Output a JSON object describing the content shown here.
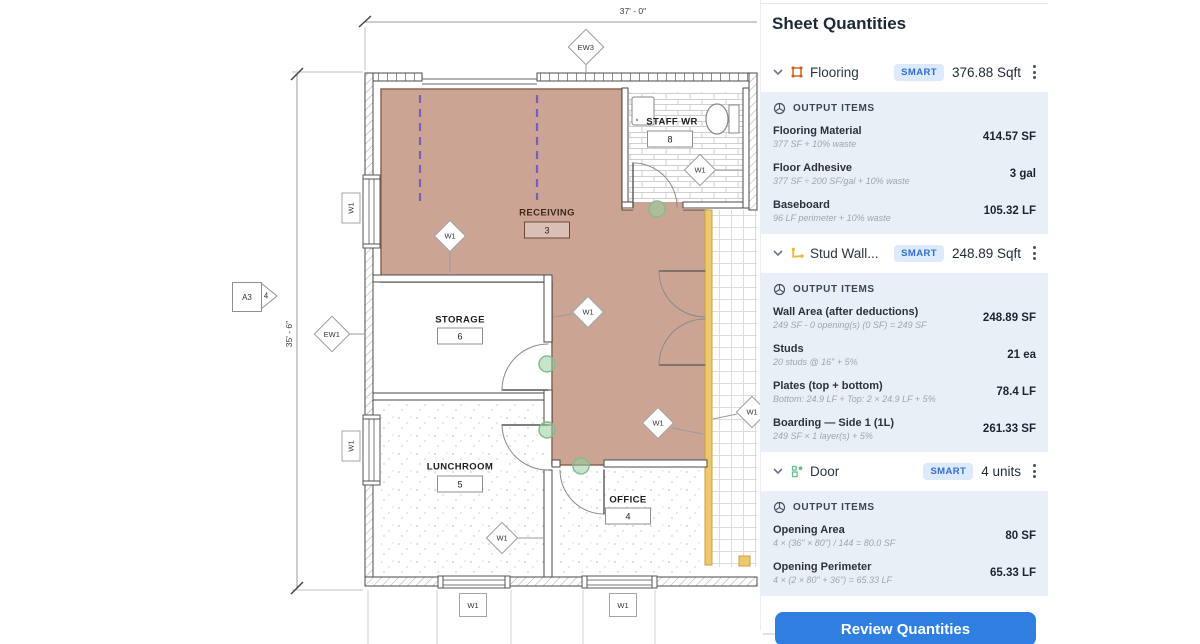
{
  "plan": {
    "dimensions": {
      "top": "37' - 0\"",
      "left": "35' - 6\""
    },
    "section_marker": {
      "sheet": "A3",
      "detail": "4"
    },
    "wall_tags": {
      "ew3": "EW3",
      "ew1": "EW1",
      "w1": "W1"
    },
    "rooms": [
      {
        "name": "RECEIVING",
        "number": "3"
      },
      {
        "name": "STAFF WR",
        "number": "8"
      },
      {
        "name": "STORAGE",
        "number": "6"
      },
      {
        "name": "LUNCHROOM",
        "number": "5"
      },
      {
        "name": "OFFICE",
        "number": "4"
      }
    ],
    "colors": {
      "flooring_highlight": "#cba494",
      "wall_highlight_yellow": "#eec86e",
      "vertex_marker_green": "#8cc89a",
      "overhead_dashed_purple": "#7a5fb5"
    }
  },
  "panel": {
    "title": "Sheet Quantities",
    "output_items_label": "OUTPUT ITEMS",
    "review_button": "Review Quantities",
    "icons": {
      "flooring": "area-takeoff-icon",
      "stud_wall": "linear-takeoff-icon",
      "door": "count-takeoff-icon",
      "output_items": "cube-icon",
      "section_expand": "chevron-down-icon",
      "section_menu": "kebab-menu-icon"
    },
    "colors": {
      "accent_blue": "#2e7fe0",
      "badge_bg": "#dde9fc",
      "badge_text": "#2e6fd6",
      "output_block_bg": "#e9eff7",
      "flooring_icon": "#d9703c",
      "stud_icon": "#e8b93c",
      "door_icon": "#6abf8a"
    },
    "sections": [
      {
        "name": "Flooring",
        "badge": "SMART",
        "quantity": "376.88 Sqft",
        "items": [
          {
            "title": "Flooring Material",
            "formula": "377 SF + 10% waste",
            "value": "414.57 SF"
          },
          {
            "title": "Floor Adhesive",
            "formula": "377 SF ÷ 200 SF/gal + 10% waste",
            "value": "3 gal"
          },
          {
            "title": "Baseboard",
            "formula": "96 LF perimeter + 10% waste",
            "value": "105.32 LF"
          }
        ]
      },
      {
        "name": "Stud Wall...",
        "badge": "SMART",
        "quantity": "248.89 Sqft",
        "items": [
          {
            "title": "Wall Area (after deductions)",
            "formula": "249 SF - 0 opening(s) (0 SF) = 249 SF",
            "value": "248.89 SF"
          },
          {
            "title": "Studs",
            "formula": "20 studs @ 16\" + 5%",
            "value": "21 ea"
          },
          {
            "title": "Plates (top + bottom)",
            "formula": "Bottom: 24.9 LF + Top: 2 × 24.9 LF + 5%",
            "value": "78.4 LF"
          },
          {
            "title": "Boarding — Side 1 (1L)",
            "formula": "249 SF × 1 layer(s) + 5%",
            "value": "261.33 SF"
          }
        ]
      },
      {
        "name": "Door",
        "badge": "SMART",
        "quantity": "4 units",
        "items": [
          {
            "title": "Opening Area",
            "formula": "4 × (36\" × 80\") / 144 = 80.0 SF",
            "value": "80 SF"
          },
          {
            "title": "Opening Perimeter",
            "formula": "4 × (2 × 80\" + 36\") = 65.33 LF",
            "value": "65.33 LF"
          }
        ]
      }
    ]
  }
}
